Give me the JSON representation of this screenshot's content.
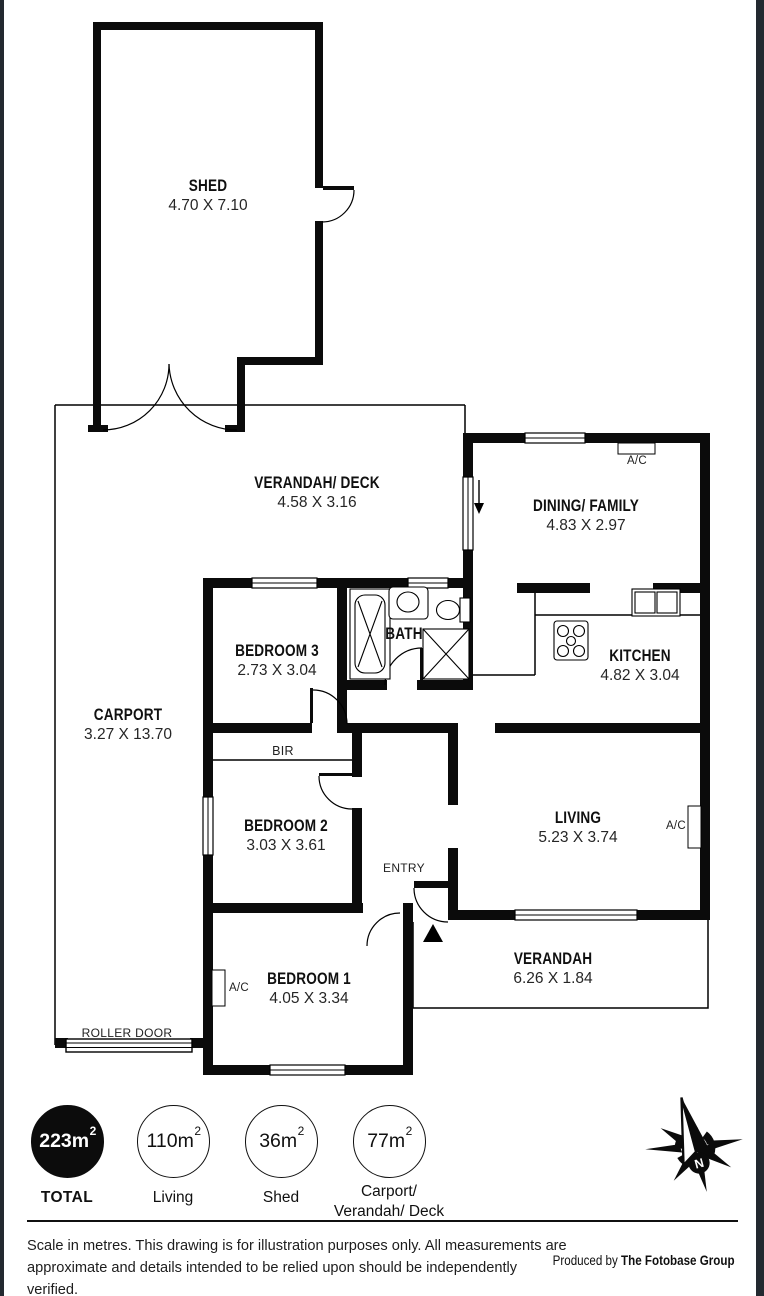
{
  "plan_type": "residential-floorplan",
  "edge_color": "#232930",
  "rooms": {
    "shed": {
      "name": "SHED",
      "dims": "4.70 X 7.10"
    },
    "verandah_deck": {
      "name": "VERANDAH/ DECK",
      "dims": "4.58 X 3.16"
    },
    "dining": {
      "name": "DINING/ FAMILY",
      "dims": "4.83 X 2.97"
    },
    "bedroom3": {
      "name": "BEDROOM 3",
      "dims": "2.73 X 3.04"
    },
    "bath": {
      "name": "BATH"
    },
    "kitchen": {
      "name": "KITCHEN",
      "dims": "4.82 X 3.04"
    },
    "carport": {
      "name": "CARPORT",
      "dims": "3.27 X 13.70"
    },
    "bedroom2": {
      "name": "BEDROOM 2",
      "dims": "3.03 X 3.61"
    },
    "living": {
      "name": "LIVING",
      "dims": "5.23 X 3.74"
    },
    "bedroom1": {
      "name": "BEDROOM 1",
      "dims": "4.05 X 3.34"
    },
    "verandah": {
      "name": "VERANDAH",
      "dims": "6.26 X 1.84"
    }
  },
  "features": {
    "bir": "BIR",
    "entry": "ENTRY",
    "roller_door": "ROLLER DOOR",
    "ac_dining": "A/C",
    "ac_living": "A/C",
    "ac_bedroom1": "A/C",
    "compass_north": "N"
  },
  "area_badges": [
    {
      "value": "223m",
      "sup": "2",
      "label": "TOTAL",
      "label2": ""
    },
    {
      "value": "110m",
      "sup": "2",
      "label": "Living",
      "label2": ""
    },
    {
      "value": "36m",
      "sup": "2",
      "label": "Shed",
      "label2": ""
    },
    {
      "value": "77m",
      "sup": "2",
      "label": "Carport/",
      "label2": "Verandah/ Deck"
    }
  ],
  "footer": {
    "disclaimer_line1": "Scale in metres. This drawing is for illustration purposes only. All measurements are",
    "disclaimer_line2": "approximate and details intended to be relied upon should be independently verified.",
    "produced_prefix": "Produced by ",
    "produced_name": "The Fotobase Group"
  }
}
